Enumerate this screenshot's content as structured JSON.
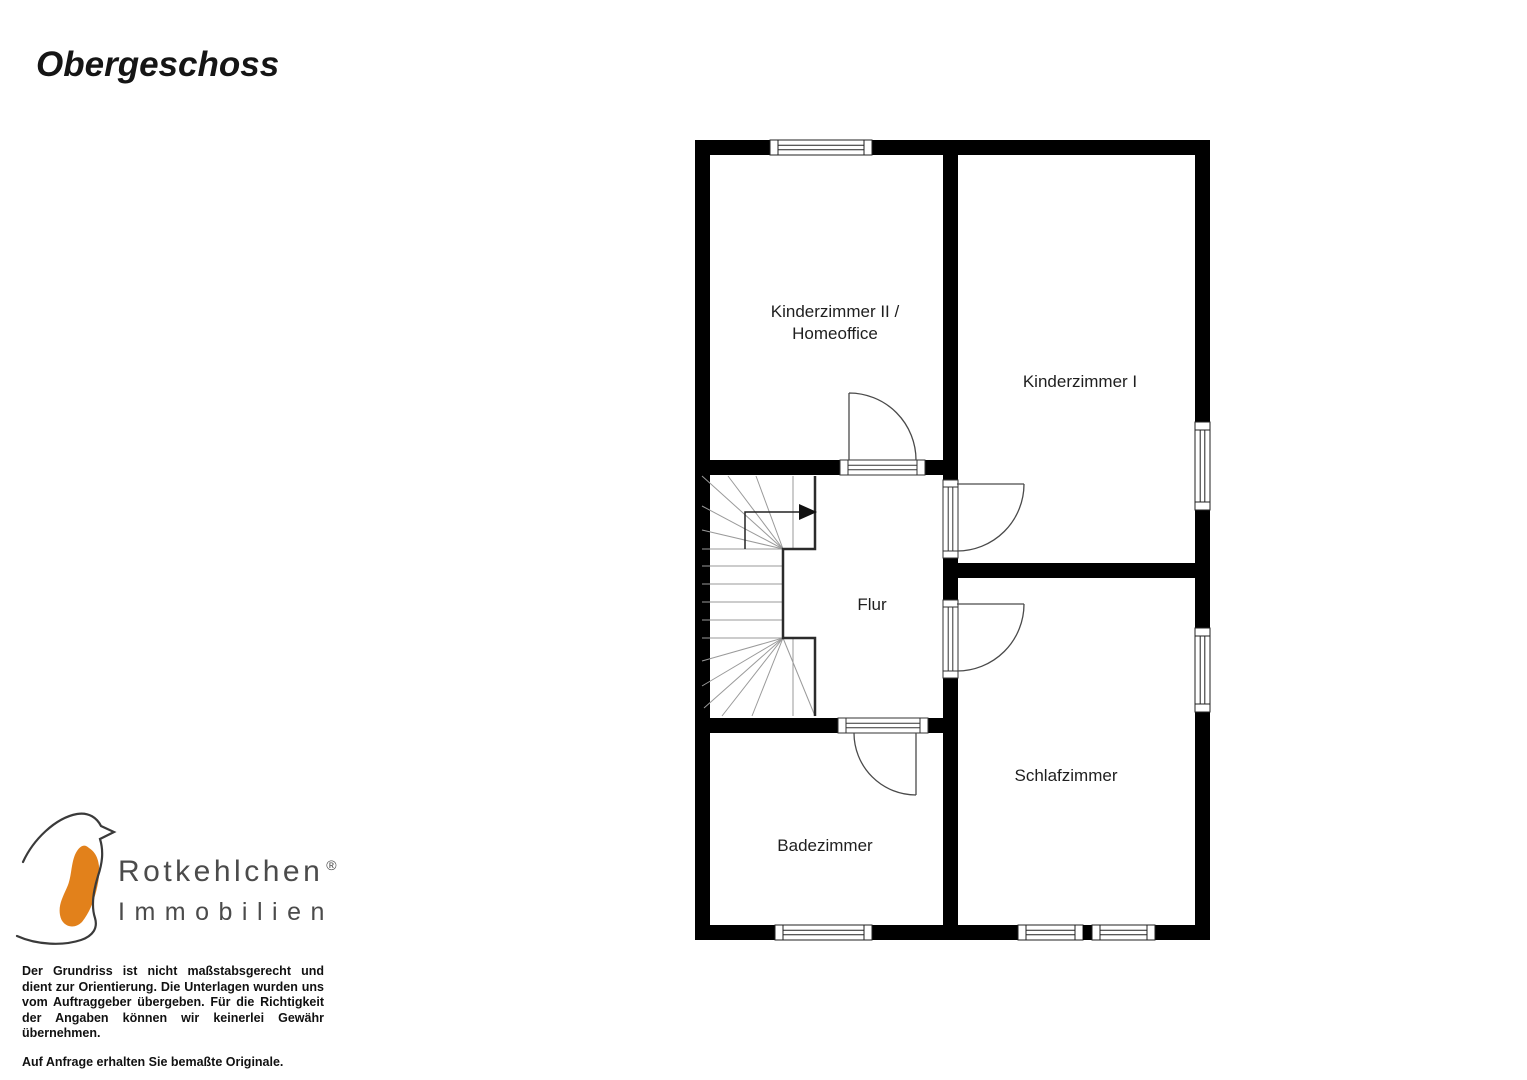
{
  "page": {
    "title": "Obergeschoss"
  },
  "floorplan": {
    "rooms": [
      {
        "id": "kinderzimmer-2",
        "label_line1": "Kinderzimmer II /",
        "label_line2": "Homeoffice"
      },
      {
        "id": "kinderzimmer-1",
        "label": "Kinderzimmer I"
      },
      {
        "id": "flur",
        "label": "Flur"
      },
      {
        "id": "schlafzimmer",
        "label": "Schlafzimmer"
      },
      {
        "id": "badezimmer",
        "label": "Badezimmer"
      }
    ],
    "features": {
      "stairs": "winder-staircase-with-up-arrow",
      "doors": 4,
      "windows": 6
    },
    "wall_color": "#000000",
    "line_color": "#4a4a4a"
  },
  "logo": {
    "brand": "Rotkehlchen",
    "registered": "®",
    "subtitle": "Immobilien",
    "icon": "robin-bird-icon",
    "accent_color": "#E2811B",
    "text_color": "#4b4b4b"
  },
  "disclaimer": {
    "paragraph1": "Der Grundriss ist nicht maßstabsgerecht und dient zur Orientierung. Die Unterlagen wurden uns vom Auftraggeber übergeben. Für die Richtigkeit der Angaben können wir keinerlei Gewähr übernehmen.",
    "paragraph2": "Auf Anfrage erhalten Sie bemaßte Originale."
  }
}
